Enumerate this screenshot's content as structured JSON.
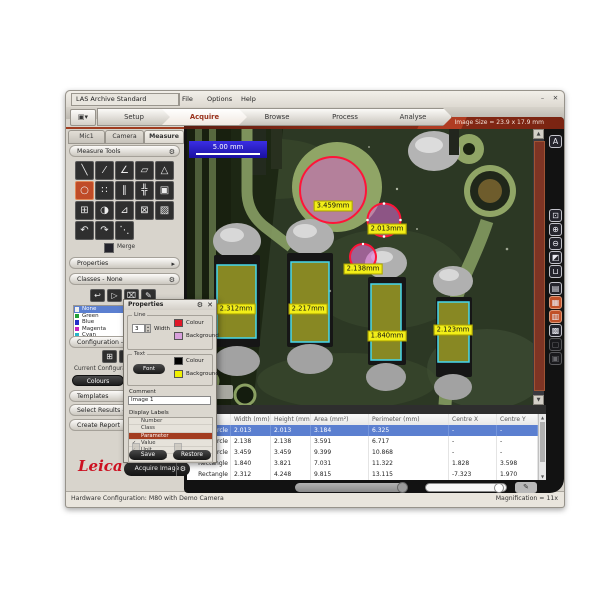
{
  "menu": {
    "app_selector": "LAS Archive Standard",
    "items": [
      "File",
      "Options",
      "Help"
    ],
    "minimize_glyph": "–",
    "close_glyph": "✕"
  },
  "workflow_tabs": [
    "Setup",
    "Acquire",
    "Browse",
    "Process",
    "Analyse"
  ],
  "view_selector_glyph": "▣▾",
  "live": {
    "label": "Live",
    "image_size": "Image Size = 23.9 x 17.9 mm"
  },
  "sidebar": {
    "tabs": [
      "Mic1",
      "Camera",
      "Measure"
    ],
    "measure_tools_title": "Measure Tools",
    "tool_glyphs": [
      "╲",
      "⁄",
      "∠",
      "▱",
      "△",
      "○",
      "∷",
      "∥",
      "╬",
      "▣",
      "⊞",
      "◑",
      "⊿",
      "⊠",
      "▨",
      "↶",
      "↷",
      "⋱"
    ],
    "merge_label": "Merge",
    "properties_title": "Properties",
    "classes_title": "Classes - None",
    "class_action_glyphs": [
      "↩",
      "▷",
      "⌧",
      "✎"
    ],
    "classes": [
      {
        "label": "None",
        "color": "#f0f0f0"
      },
      {
        "label": "Green",
        "color": "#22a038"
      },
      {
        "label": "Blue",
        "color": "#2430c8"
      },
      {
        "label": "Magenta",
        "color": "#c424c0"
      },
      {
        "label": "Cyan",
        "color": "#28b4c8"
      },
      {
        "label": "Yellow",
        "color": "#d4d428"
      }
    ],
    "config_title": "Configuration - Colo",
    "config_action_glyphs": [
      "⊞",
      "▤"
    ],
    "current_config_label": "Current Configuratio",
    "colours_button": "Colours",
    "templates_button": "Templates",
    "select_results_button": "Select Results - PC",
    "create_report_button": "Create Report"
  },
  "dialog": {
    "title": "Properties",
    "gear_glyph": "⚙",
    "close_glyph": "✕",
    "line_group": "Line",
    "width_value": "3",
    "width_label": "Width",
    "colour_label": "Colour",
    "background_label": "Background",
    "text_group": "Text",
    "font_button": "Font",
    "comment_label": "Comment",
    "comment_value": "Image 1",
    "display_labels_title": "Display Labels",
    "display_items": [
      {
        "label": "Number",
        "check": ""
      },
      {
        "label": "Class",
        "check": ""
      },
      {
        "label": "Parameter",
        "check": ""
      },
      {
        "label": "Value",
        "check": "✓"
      },
      {
        "label": "Unit",
        "check": "✓"
      },
      {
        "label": "Comment",
        "check": ""
      }
    ],
    "save_button": "Save",
    "restore_button": "Restore",
    "colors": {
      "line_colour": "#e01828",
      "line_background": "#d8a0dc",
      "text_colour": "#000000",
      "text_background": "#f0f000"
    },
    "spinner_up_glyph": "▴",
    "spinner_down_glyph": "▾"
  },
  "viewer": {
    "scale_label": "5.00 mm",
    "circle_labels": [
      "3.459mm",
      "2.013mm",
      "2.138mm"
    ],
    "rect_labels": [
      "2.312mm",
      "2.217mm",
      "1.840mm",
      "2.123mm"
    ],
    "annotation_colors": {
      "circle_outline": "#ff1438",
      "circle_fill": "#d85cd0",
      "rect_outline": "#46d8ee",
      "rect_fill": "#e8e830"
    }
  },
  "right_toolbar_glyphs": [
    "A",
    "⊡",
    "⊕",
    "⊖",
    "◩",
    "⊔",
    "▤",
    "▦",
    "▥",
    "▩",
    "▢",
    "▣"
  ],
  "scroll_glyphs": {
    "up": "▲",
    "down": "▼",
    "left": "◀",
    "right": "▶"
  },
  "results_table": {
    "columns": [
      "",
      "Width (mm)",
      "Height (mm)",
      "Area (mm²)",
      "Perimeter (mm)",
      "Centre X",
      "Centre Y"
    ],
    "sort_glyph": "▵",
    "rows": [
      [
        "3PointCircle",
        "2.013",
        "2.013",
        "3.184",
        "6.325",
        "-",
        "-"
      ],
      [
        "3PointCircle",
        "2.138",
        "2.138",
        "3.591",
        "6.717",
        "-",
        "-"
      ],
      [
        "3PointCircle",
        "3.459",
        "3.459",
        "9.399",
        "10.868",
        "-",
        "-"
      ],
      [
        "Rectangle",
        "1.840",
        "3.821",
        "7.031",
        "11.322",
        "1.828",
        "3.598"
      ],
      [
        "Rectangle",
        "2.312",
        "4.248",
        "9.815",
        "13.115",
        "-7.323",
        "1.970"
      ]
    ]
  },
  "footer": {
    "brand": "Leica",
    "acquire_button": "Acquire Image",
    "acquire_gear_glyph": "⚙"
  },
  "status": {
    "left": "Hardware Configuration: M80 with Demo Camera",
    "right": "Magnification = 11x"
  }
}
